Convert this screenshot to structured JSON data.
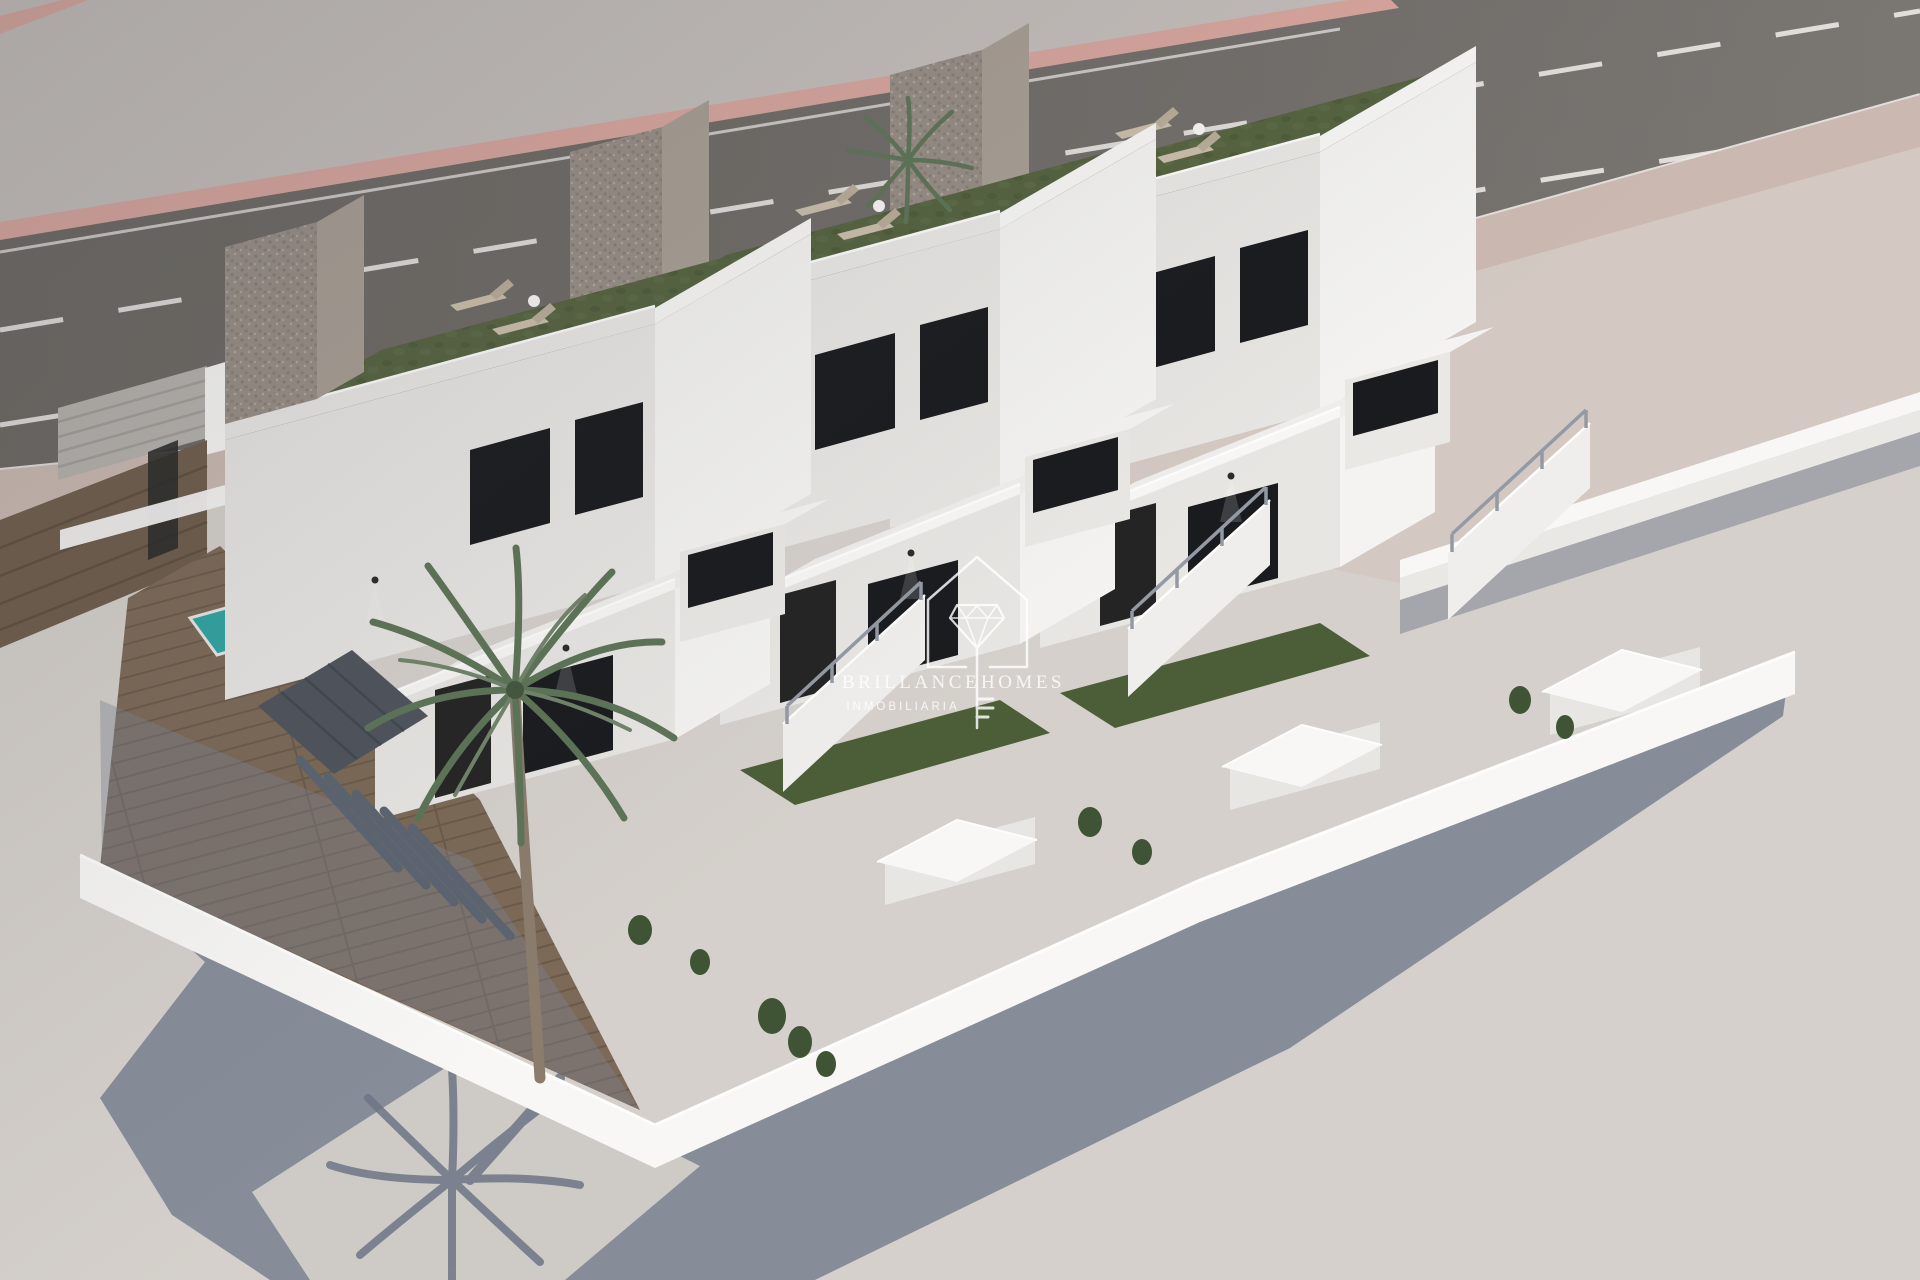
{
  "page": {
    "title": "Brillance Homes Inmobiliaria – aerial 3D render of new build townhouses"
  },
  "image": {
    "type": "3d-architectural-render",
    "subject": "Aerial view of three identical modern white two-storey townhouses with rooftop grass terraces",
    "visible_elements": [
      "asphalt road with dashed white lane markings behind the plot",
      "pink kerb strips along the road",
      "pale pink sidewalk",
      "white perimeter walls around the plot",
      "grey stone feature wall on each house",
      "rooftop terrace with artificial grass and two sun loungers per house",
      "external staircases with grey handrails",
      "dark glazed doors and windows",
      "wall lamps on the facades",
      "wood deck with small teal swimming pool",
      "large palm tree in the front garden and a smaller palm behind",
      "green shrubs in the front yards",
      "gate pillars with pitched white caps",
      "long blue-grey shadows cast to the lower left",
      "palm tree shadow on the ground"
    ]
  },
  "watermark": {
    "brand_left": "BRILLANCE",
    "brand_right": "HOMES",
    "subtitle": "INMOBILIARIA",
    "logo": "house outline containing a cut diamond whose shaft forms a key"
  },
  "scene": {
    "houses_count": 3,
    "sun_loungers_per_roof": 2,
    "palm_trees": 2,
    "pool": {
      "shape": "small rectangle",
      "finish": "teal water"
    }
  },
  "colors": {
    "ground": "#d5d0cb",
    "far_band": "#c5bfbb",
    "pink": "#d9a69e",
    "marking": "#eceae7",
    "sidewalk": "#cbb9b1",
    "neighbor_ground": "#d3c9c2",
    "shadow": "#7b8392",
    "wall_white": "#f8f7f5",
    "wall_face": "#eae8e5",
    "wall_top": "#fdfdfc",
    "white_front": "#e8e6e3",
    "white_lit": "#f4f3f1",
    "white_mid": "#f0eeec",
    "glass": "#191b1e",
    "door": "#242424",
    "grass_roof": "#55633f",
    "yard_grass": "#4c5e37",
    "stone": "#978e85",
    "stone_side": "#a89e94",
    "stone_dot": "#867d74",
    "deck": "#7c6957",
    "deck_line": "#6b5a49",
    "pool": "#2fa4a1",
    "pool_edge": "#e9e7e3",
    "lounger": "#cbbfaa",
    "lounger_dark": "#b9ad97",
    "pergola": "#5b6470",
    "canopy": "#4e545c",
    "canopy_line": "#42474f",
    "palm": "#5d7457",
    "palm_light": "#71846a",
    "trunk": "#8b7c6c",
    "palm_shadow": "#6d7585",
    "fence_wood": "#6e5c4b",
    "fence_line": "#5e4e3e",
    "gate_gray": "#b6b2ad",
    "gate_line": "#a29e99",
    "shrub": "#3f5434",
    "lamp": "#2b2b2b",
    "rail": "#949aa3",
    "road_dark": "#6b6762",
    "road_light": "#7a7672",
    "watermark": "#ffffff"
  }
}
